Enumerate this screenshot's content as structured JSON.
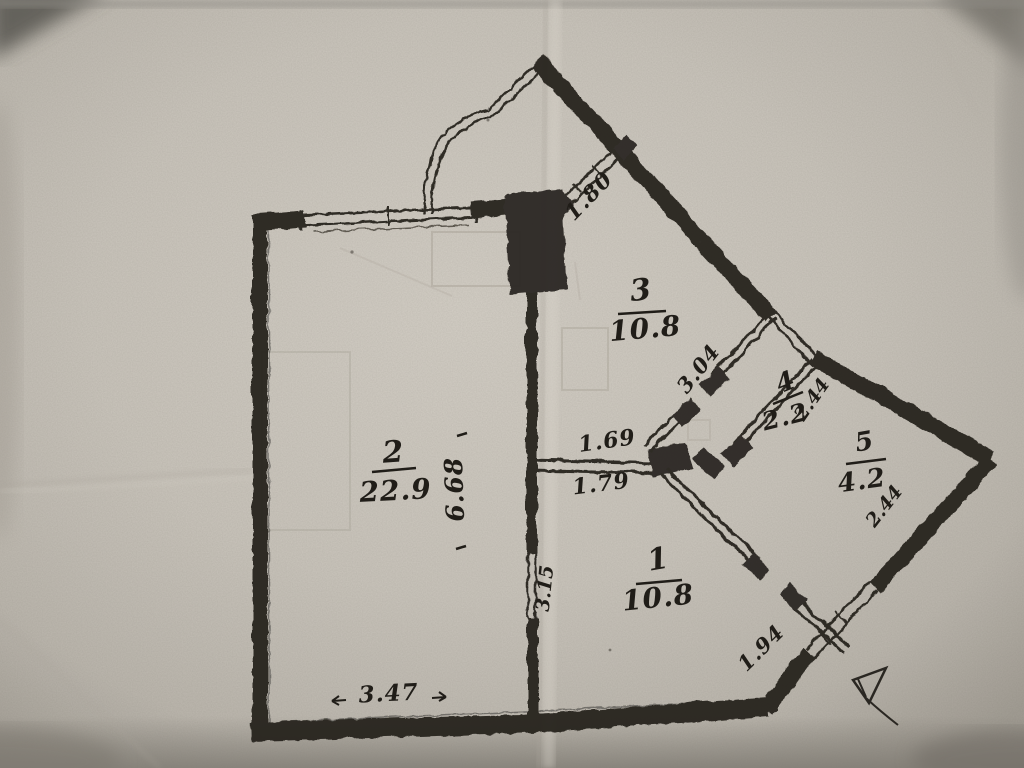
{
  "plan": {
    "rooms": {
      "1": {
        "number": "1",
        "area": "10.8"
      },
      "2": {
        "number": "2",
        "area": "22.9"
      },
      "3": {
        "number": "3",
        "area": "10.8"
      },
      "4": {
        "number": "4",
        "area": "2.2"
      },
      "5": {
        "number": "5",
        "area": "4.2"
      }
    },
    "dims": {
      "balcony_window": "1.80",
      "room3_wall": "3.04",
      "room4_depth": "2.44",
      "room5_depth": "2.44",
      "hall_top": "1.69",
      "hall_bottom": "1.79",
      "room2_depth": "6.68",
      "room1_depth": "3.15",
      "room1_window": "1.94",
      "room2_width": "3.47"
    }
  },
  "colors": {
    "paper": "#ccc7be",
    "ink": "#26231e",
    "pencil": "#a49e93"
  }
}
